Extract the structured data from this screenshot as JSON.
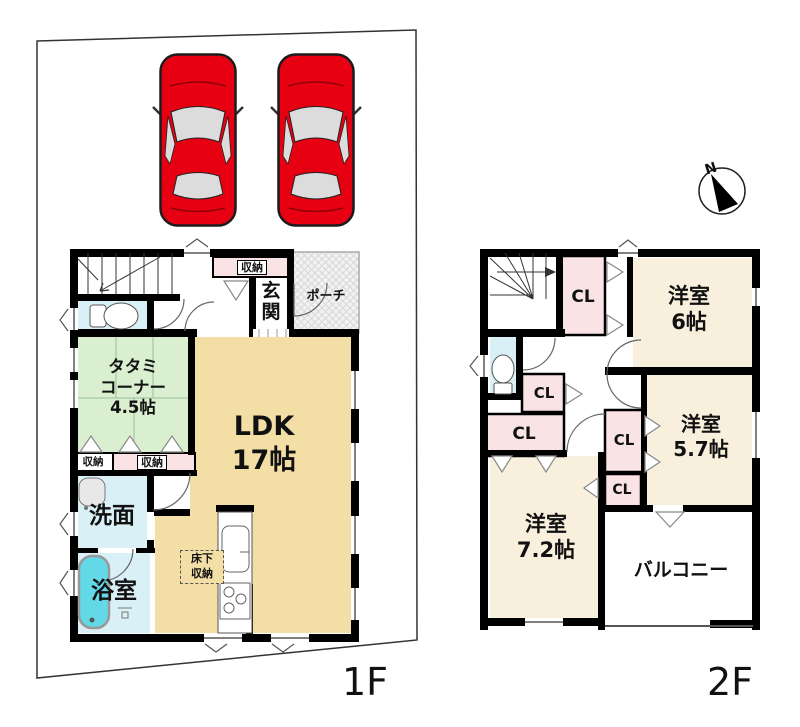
{
  "compass": {
    "north_label": "N"
  },
  "floor_1f": {
    "label": "1F",
    "storage_top": "収納",
    "entrance": "玄関",
    "porch": "ポーチ",
    "tatami_l1": "タタミ",
    "tatami_l2": "コーナー",
    "tatami_l3": "4.5帖",
    "ldk_l1": "LDK",
    "ldk_l2": "17帖",
    "storage_left": "収納",
    "storage_mid": "収納",
    "washroom": "洗面",
    "bathroom": "浴室",
    "underfloor_l1": "床下",
    "underfloor_l2": "収納"
  },
  "floor_2f": {
    "label": "2F",
    "closet": "CL",
    "bedroom6_l1": "洋室",
    "bedroom6_l2": "6帖",
    "bedroom57_l1": "洋室",
    "bedroom57_l2": "5.7帖",
    "bedroom72_l1": "洋室",
    "bedroom72_l2": "7.2帖",
    "balcony": "バルコニー"
  },
  "colors": {
    "wall": "#000000",
    "ldk_tan": "#f3dfa6",
    "tatami_green": "#d9efcf",
    "water_blue": "#d9f1f6",
    "closet_pink": "#f9e3e5",
    "bedroom_cream": "#f8f0dd",
    "bathtub_cyan": "#63d9e8",
    "car_red": "#e60012",
    "porch_gray": "#f2f2f2"
  }
}
